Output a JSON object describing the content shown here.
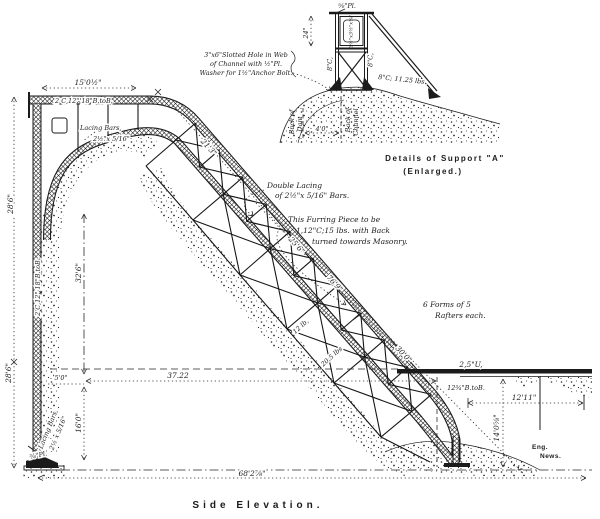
{
  "colors": {
    "ink": "#1b1b1b",
    "paper": "#ffffff"
  },
  "drawing": {
    "caption": "Side  Elevation.",
    "detail": {
      "caption_line1": "Details of Support \"A\"",
      "caption_line2": "(Enlarged.)",
      "plate_top": "⅝\"Pl.",
      "dim_height": "24\"",
      "angle_label": "3½\"x3½\"x⅜\"",
      "channel_left": "8\"C,",
      "channel_right": "8\"C,",
      "channel_ground": "8\"C; 11.25 lbs.",
      "note_slotted_1": "3\"x6\"Slotted Hole in Web",
      "note_slotted_2": "of Channel with ½\"Pl.",
      "note_slotted_3": "Washer for 1½\"Anchor Bolt.",
      "back_of_dam_1": "Back of",
      "back_of_dam_2": "Dam",
      "back_of_channel_1": "Back of",
      "back_of_channel_2": "Channel",
      "dim_base": "4'0\""
    },
    "elevation": {
      "dim_top": "15'0½\"",
      "top_chord": "2 C,12\" 18\"B.toB.",
      "lacing_top_1": "Lacing Bars,",
      "lacing_top_2": "2½\"x 5/16\"",
      "dim_21_3": "21'3\"",
      "note_lacing_1": "Double Lacing",
      "note_lacing_2": "of 2½\"x 5/16\" Bars.",
      "note_furring_1": "This Furring Piece to be",
      "note_furring_2": "1,12\"C;15 lbs. with Back",
      "note_furring_3": "turned towards Masonry.",
      "dim_25_6": "25'6\"",
      "dim_76_9": "76'9\"",
      "dim_30_0": "30'0\"",
      "note_rafters_1": "6 Forms of 5",
      "note_rafters_2": "Rafters each.",
      "member_12lb": "12 lb,",
      "member_20_5": "20.5 lbs",
      "dim_37_22": "37.22",
      "dim_5_0": "5'0\"",
      "dim_16_0": "16'0\"",
      "dim_32_6": "32'6\"",
      "dim_28_6_upper": "28'6\"",
      "dim_28_6_lower": "28'6\"",
      "column_label": "2 C,12\" 18\"B.toB.",
      "column_lacing_1": "Lacing Bars,",
      "column_lacing_2": "2½ x 5/16\"",
      "plate_bottom": "⅜\"Pl.",
      "dim_68": "68'2⅞\"",
      "deck_label_1": "2,5\"U,",
      "deck_label_2": "12¾\"B.toB.",
      "dim_12_11": "12'11\"",
      "dim_14_0": "14'0⅝\"",
      "sig_1": "Eng.",
      "sig_2": "News."
    }
  }
}
